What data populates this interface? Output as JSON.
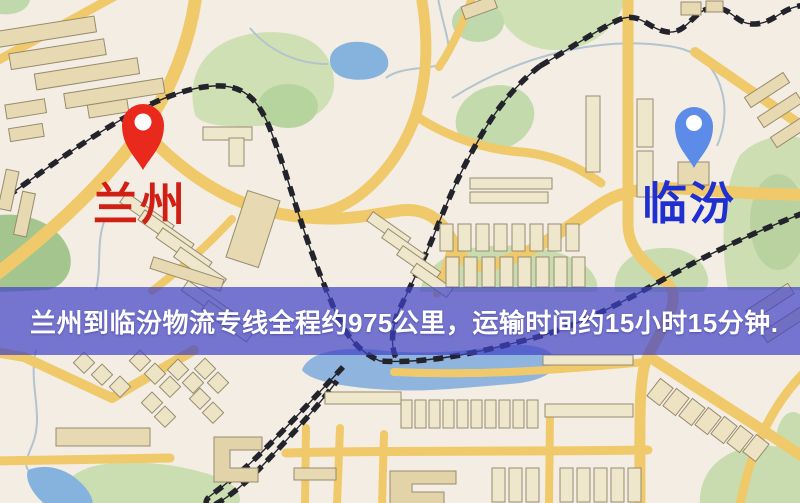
{
  "banner": {
    "text": "兰州到临汾物流专线全程约975公里，运输时间约15小时15分钟.",
    "origin": "兰州",
    "destination": "临汾",
    "distance": "975公里",
    "duration": "15小时15分钟"
  },
  "markers": {
    "origin": {
      "label": "兰州"
    },
    "destination": {
      "label": "临汾"
    }
  },
  "colors": {
    "banner_overlay": "#3E42C8",
    "banner_text": "#FFFFFF",
    "origin_pin": "#E8291C",
    "origin_label": "#D01F14",
    "destination_pin": "#5C8CE8",
    "destination_label": "#1F2FD0",
    "road": "#F0CA6A",
    "water": "#8FB4DE",
    "park": "#CFE0B4",
    "railway": "#23232B",
    "background": "#F4EDE4"
  }
}
